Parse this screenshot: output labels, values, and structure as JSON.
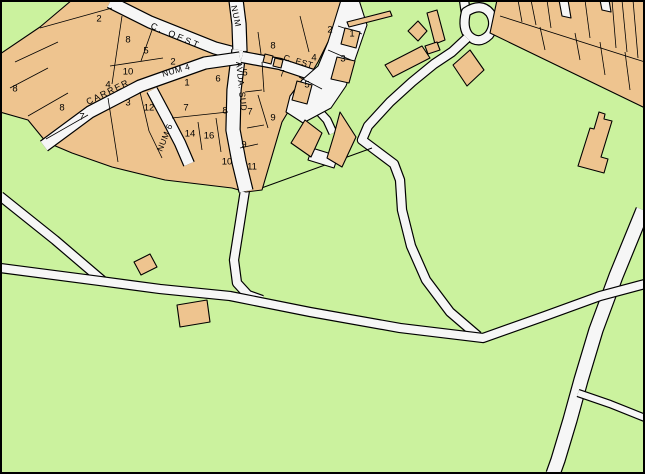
{
  "map": {
    "colors": {
      "terrain": "#cbf29e",
      "parcel": "#eec48f",
      "road": "#f6f6f6",
      "line": "#000000"
    },
    "street_labels": [
      {
        "text": "C. OEST",
        "x": 150,
        "y": 28,
        "rotation": 23,
        "spacing": 2.5,
        "size": 9
      },
      {
        "text": "NUM",
        "x": 231,
        "y": 6,
        "rotation": 78,
        "spacing": 1,
        "size": 8.5
      },
      {
        "text": "NUM 4",
        "x": 163,
        "y": 77,
        "rotation": -16,
        "spacing": 0.5,
        "size": 8.5
      },
      {
        "text": "CARRER",
        "x": 88,
        "y": 105,
        "rotation": -26,
        "spacing": 1.5,
        "size": 9
      },
      {
        "text": "NUM 6",
        "x": 162,
        "y": 152,
        "rotation": -68,
        "spacing": 0.5,
        "size": 8.5
      },
      {
        "text": "AVDA. SUD",
        "x": 236,
        "y": 62,
        "rotation": 84,
        "spacing": 0.5,
        "size": 8.5
      },
      {
        "text": "C. EST",
        "x": 283,
        "y": 60,
        "rotation": 16,
        "spacing": 0.5,
        "size": 8.5
      }
    ],
    "parcel_numbers": [
      {
        "t": "2",
        "x": 99,
        "y": 18
      },
      {
        "t": "8",
        "x": 128,
        "y": 39
      },
      {
        "t": "5",
        "x": 146,
        "y": 50
      },
      {
        "t": "2",
        "x": 173,
        "y": 61
      },
      {
        "t": "10",
        "x": 128,
        "y": 71
      },
      {
        "t": "4",
        "x": 108,
        "y": 84
      },
      {
        "t": "1",
        "x": 187,
        "y": 82
      },
      {
        "t": "8",
        "x": 15,
        "y": 88
      },
      {
        "t": "3",
        "x": 128,
        "y": 102
      },
      {
        "t": "12",
        "x": 149,
        "y": 107
      },
      {
        "t": "7",
        "x": 186,
        "y": 107
      },
      {
        "t": "8",
        "x": 62,
        "y": 107
      },
      {
        "t": "7",
        "x": 82,
        "y": 116
      },
      {
        "t": "14",
        "x": 190,
        "y": 133
      },
      {
        "t": "16",
        "x": 209,
        "y": 135
      },
      {
        "t": "10",
        "x": 227,
        "y": 161
      },
      {
        "t": "11",
        "x": 252,
        "y": 166
      },
      {
        "t": "6",
        "x": 218,
        "y": 78
      },
      {
        "t": "5",
        "x": 245,
        "y": 72
      },
      {
        "t": "8",
        "x": 225,
        "y": 110
      },
      {
        "t": "7",
        "x": 250,
        "y": 111
      },
      {
        "t": "9",
        "x": 273,
        "y": 117
      },
      {
        "t": "9",
        "x": 244,
        "y": 144
      },
      {
        "t": "8",
        "x": 273,
        "y": 45
      },
      {
        "t": "2",
        "x": 330,
        "y": 29
      },
      {
        "t": "4",
        "x": 314,
        "y": 57
      },
      {
        "t": "1",
        "x": 352,
        "y": 33
      },
      {
        "t": "3",
        "x": 343,
        "y": 58
      },
      {
        "t": "5",
        "x": 307,
        "y": 84
      },
      {
        "t": "7",
        "x": 282,
        "y": 73
      }
    ]
  }
}
